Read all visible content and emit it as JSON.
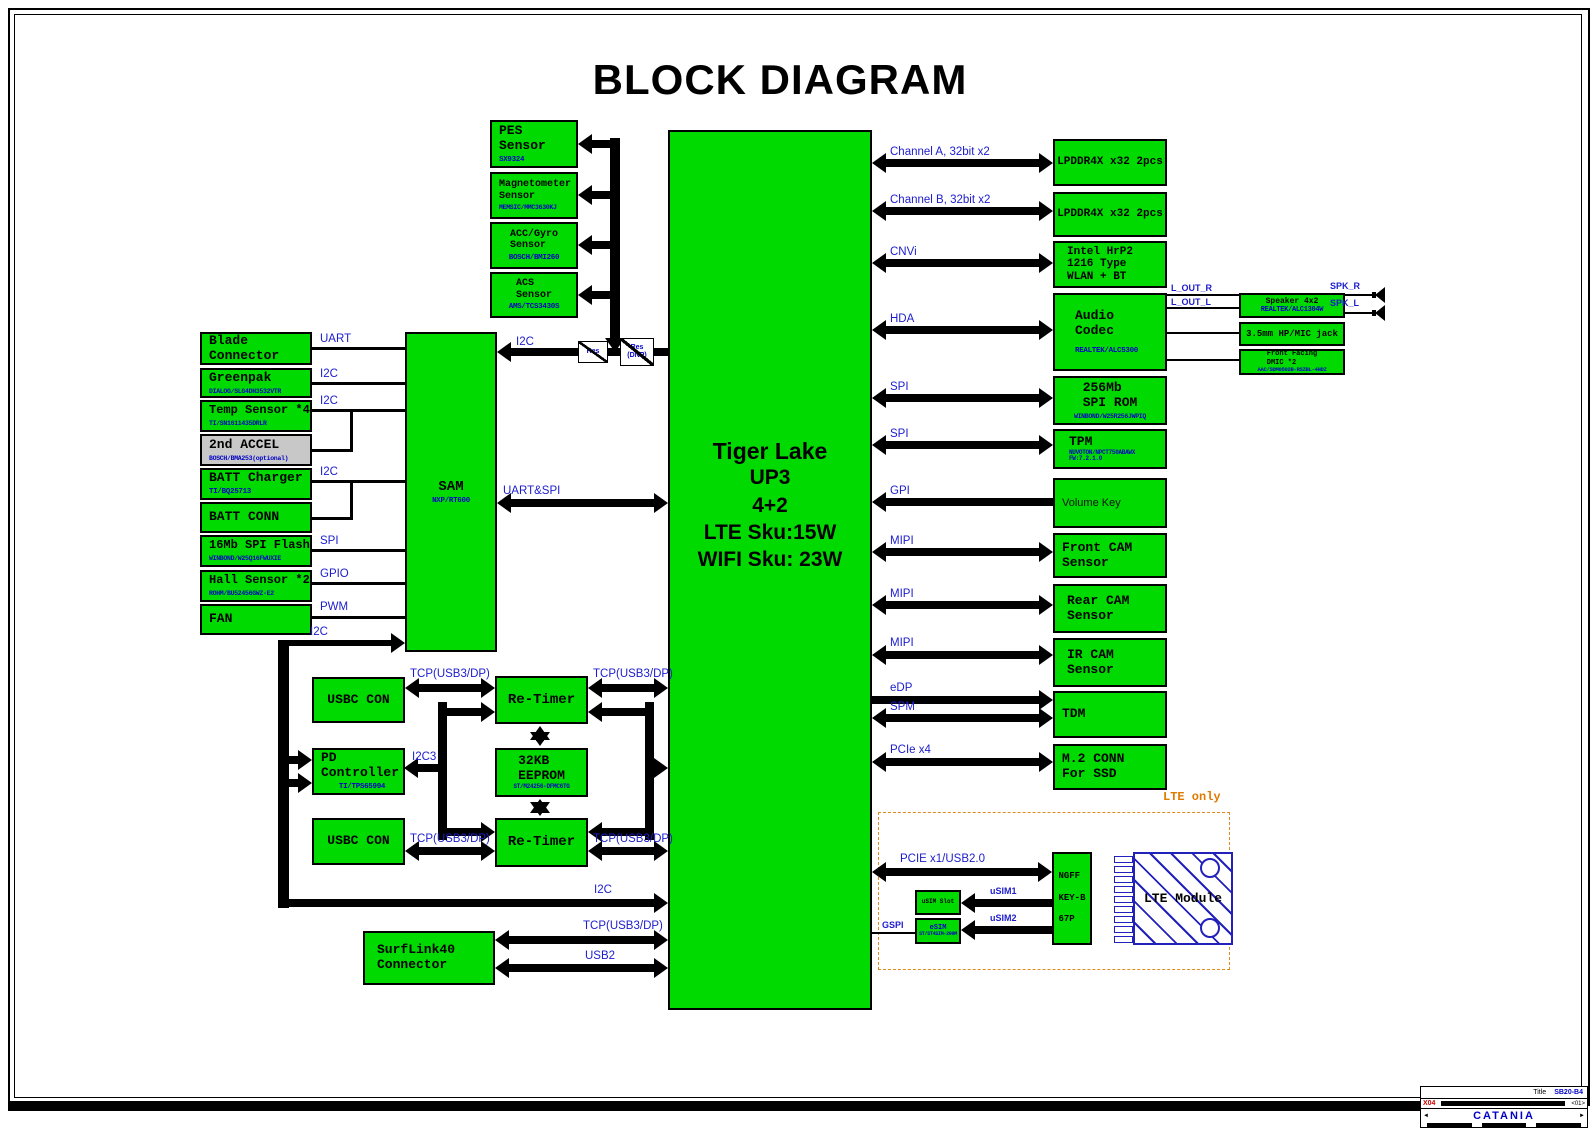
{
  "title": "BLOCK DIAGRAM",
  "cpu": {
    "name": "Tiger Lake",
    "sub": "UP3\n4+2\nLTE Sku:15W\nWIFI Sku: 23W"
  },
  "sam": {
    "label": "SAM",
    "part": "NXP/RT600"
  },
  "sensors": {
    "pes": {
      "label": "PES\nSensor",
      "part": "SX9324"
    },
    "mag": {
      "label": "Magnetometer\nSensor",
      "part": "MEMSIC/MMC3630KJ"
    },
    "accgyro": {
      "label": "ACC/Gyro\nSensor",
      "part": "BOSCH/BMI260"
    },
    "acs": {
      "label": "ACS\nSensor",
      "part": "AMS/TCS3430S"
    }
  },
  "left": {
    "blade": {
      "label": "Blade\nConnector"
    },
    "greenpak": {
      "label": "Greenpak",
      "part": "DIALOG/SLG4DH3532VTR"
    },
    "temp": {
      "label": "Temp Sensor *4",
      "part": "TI/SN1611435DRLR"
    },
    "accel2": {
      "label": "2nd ACCEL",
      "part": "BOSCH/BMA253(optional)"
    },
    "battchg": {
      "label": "BATT Charger",
      "part": "TI/BQ25713"
    },
    "battconn": {
      "label": "BATT CONN"
    },
    "flash": {
      "label": "16Mb SPI Flash",
      "part": "WINBOND/W25Q16FWUXIE"
    },
    "hall": {
      "label": "Hall Sensor *2",
      "part": "ROHM/BU52456GWZ-E2"
    },
    "fan": {
      "label": "FAN"
    }
  },
  "res1": {
    "label": "Res"
  },
  "res2": {
    "label": "Res\n(DNP)"
  },
  "right": {
    "lpddr_a": {
      "label": "LPDDR4X x32 2pcs"
    },
    "lpddr_b": {
      "label": "LPDDR4X x32 2pcs"
    },
    "wlan": {
      "label": "Intel HrP2\n1216 Type\nWLAN + BT"
    },
    "audio": {
      "label": "Audio\nCodec",
      "part": "REALTEK/ALC5300"
    },
    "spirom": {
      "label": "256Mb\nSPI ROM",
      "part": "WINBOND/W25R256JWPIQ"
    },
    "tpm": {
      "label": "TPM",
      "part": "NUVOTON/NPCT750ABAWX\nFW:7.2.1.0"
    },
    "volume": {
      "label": "Volume Key"
    },
    "frontcam": {
      "label": "Front CAM\nSensor"
    },
    "rearcam": {
      "label": "Rear CAM\nSensor"
    },
    "ircam": {
      "label": "IR CAM\nSensor"
    },
    "tdm": {
      "label": "TDM"
    },
    "m2": {
      "label": "M.2 CONN\nFor SSD"
    }
  },
  "audio_out": {
    "amp": {
      "label": "Speaker 4x2",
      "part": "REALTEK/ALC1304W"
    },
    "jack": {
      "label": "3.5mm HP/MIC jack"
    },
    "dmic": {
      "label": "Front Facing\nDMIC *2",
      "part": "AAC/SDM0502B-RSZBL-4HDZ"
    }
  },
  "bottom": {
    "usbc1": {
      "label": "USBC CON"
    },
    "retimer1": {
      "label": "Re-Timer"
    },
    "pd": {
      "label": "PD\nController",
      "part": "TI/TPS65994"
    },
    "eeprom": {
      "label": "32KB\nEEPROM",
      "part": "ST/M24256-DFMC6TG"
    },
    "usbc2": {
      "label": "USBC CON"
    },
    "retimer2": {
      "label": "Re-Timer"
    },
    "surflink": {
      "label": "SurfLink40\nConnector"
    }
  },
  "lte": {
    "zone_label": "LTE only",
    "ngff": {
      "label": "NGFF\nKEY-B\n67P"
    },
    "usim": {
      "label": "uSIM Slot"
    },
    "esim": {
      "label": "eSIM",
      "part": "ST/ST4SIM-200M"
    },
    "module": {
      "label": "LTE Module"
    }
  },
  "wire_labels": {
    "uart": "UART",
    "i2c_greenpak": "I2C",
    "i2c_temp": "I2C",
    "i2c_batt": "I2C",
    "spi_flash": "SPI",
    "gpio": "GPIO",
    "pwm": "PWM",
    "i2c_sam_bottom": "I2C",
    "i2c_sam_cpu": "I2C",
    "uart_spi": "UART&SPI",
    "cha": "Channel A, 32bit x2",
    "chb": "Channel B, 32bit x2",
    "cnvi": "CNVi",
    "hda": "HDA",
    "spi_rom": "SPI",
    "spi_tpm": "SPI",
    "gpi": "GPI",
    "mipi1": "MIPI",
    "mipi2": "MIPI",
    "mipi3": "MIPI",
    "edp": "eDP",
    "spm": "SPM",
    "pcie4": "PCIe x4",
    "tcp1a": "TCP(USB3/DP)",
    "tcp1b": "TCP(USB3/DP)",
    "i2c3": "I2C3",
    "tcp2a": "TCP(USB3/DP)",
    "tcp2b": "TCP(USB3/DP)",
    "i2c_cpu": "I2C",
    "tcp_surf": "TCP(USB3/DP)",
    "usb2": "USB2",
    "pcie1": "PCIE x1/USB2.0",
    "usim1": "uSIM1",
    "usim2": "uSIM2",
    "gspi": "GSPI",
    "lout_r": "L_OUT_R",
    "lout_l": "L_OUT_L",
    "spk_r": "SPK_R",
    "spk_l": "SPK_L"
  },
  "titleblock": {
    "title_label": "Title",
    "doc": "SB20-B4",
    "rev": "X04",
    "rev2": "<01>",
    "project": "CATANIA",
    "nav_left": "◄",
    "nav_right": "►"
  }
}
